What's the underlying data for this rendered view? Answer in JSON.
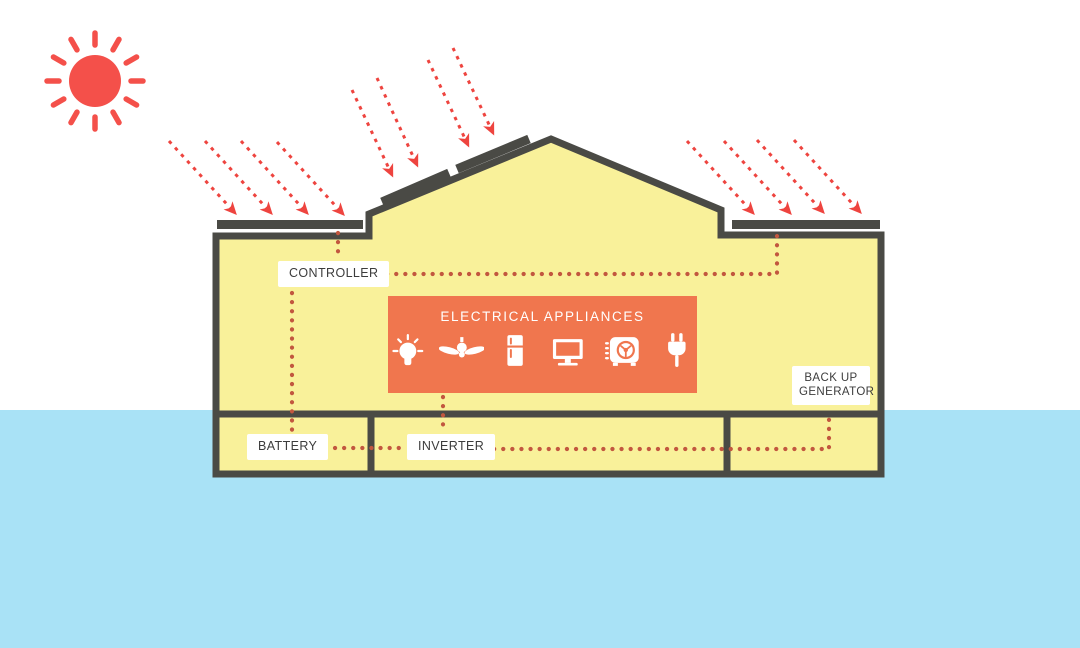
{
  "diagram": {
    "labels": {
      "controller": "CONTROLLER",
      "battery": "BATTERY",
      "inverter": "INVERTER",
      "backup_generator": "BACK UP GENERATOR"
    },
    "appliances": {
      "title": "ELECTRICAL APPLIANCES",
      "icons": [
        "light-bulb",
        "ceiling-fan",
        "refrigerator",
        "television",
        "air-conditioner",
        "power-plug"
      ]
    },
    "components": [
      "SUN",
      "SOLAR PANELS",
      "CONTROLLER",
      "ELECTRICAL APPLIANCES",
      "BATTERY",
      "INVERTER",
      "BACK UP GENERATOR"
    ],
    "connections": [
      {
        "from": "left-solar-panel",
        "to": "controller"
      },
      {
        "from": "right-solar-panel",
        "to": "controller"
      },
      {
        "from": "controller",
        "to": "battery"
      },
      {
        "from": "electrical-appliances",
        "to": "inverter"
      },
      {
        "from": "battery",
        "to": "inverter"
      },
      {
        "from": "inverter",
        "to": "backup-generator"
      }
    ],
    "colors": {
      "sun_red": "#F4504A",
      "ray_red": "#EE443F",
      "wire_dot": "#C2573F",
      "house_yellow": "#F9F19A",
      "outline_dark": "#4A4A45",
      "appliance_orange": "#F0764E",
      "ground_blue": "#A9E2F6",
      "label_text": "#3C3C3C",
      "label_bg": "#FFFFFF"
    }
  }
}
